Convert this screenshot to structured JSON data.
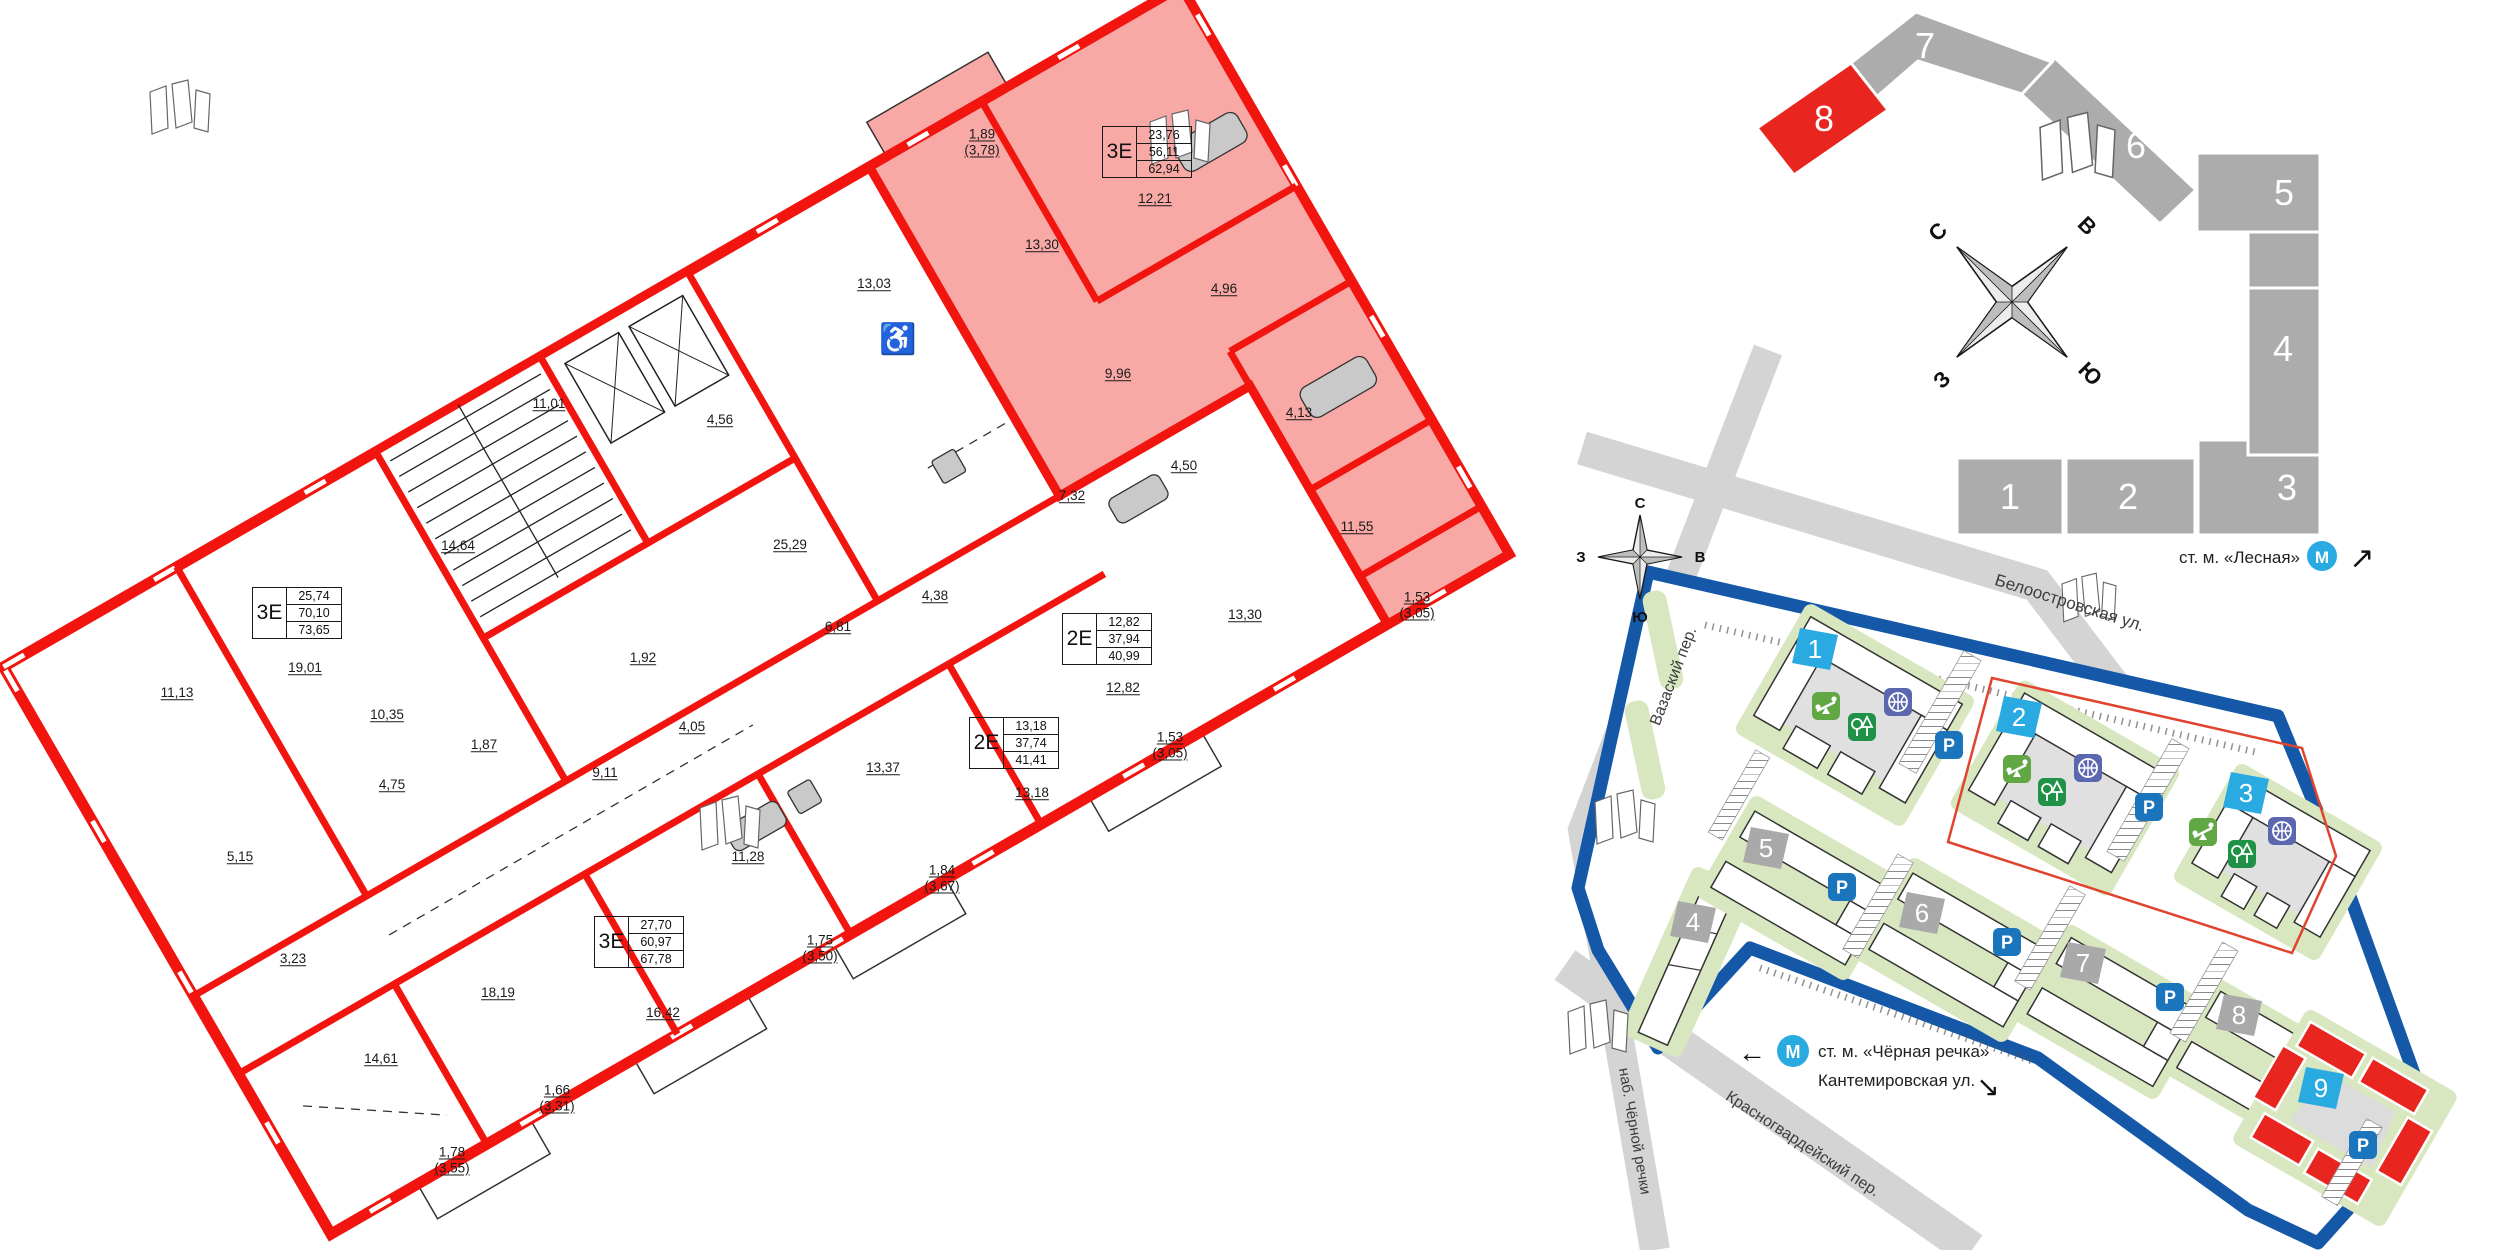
{
  "floor_plan": {
    "wheelchair_icon": "♿",
    "apartment_boxes": [
      {
        "type": "3Е",
        "values": [
          "23,76",
          "56,11",
          "62,94"
        ],
        "highlighted": true
      },
      {
        "type": "2Е",
        "values": [
          "12,82",
          "37,94",
          "40,99"
        ],
        "highlighted": false
      },
      {
        "type": "2Е",
        "values": [
          "13,18",
          "37,74",
          "41,41"
        ],
        "highlighted": false
      },
      {
        "type": "3Е",
        "values": [
          "25,74",
          "70,10",
          "73,65"
        ],
        "highlighted": false
      },
      {
        "type": "3Е",
        "values": [
          "27,70",
          "60,97",
          "67,78"
        ],
        "highlighted": false
      }
    ],
    "room_labels": [
      {
        "area": "1,89",
        "sub": "(3,78)"
      },
      {
        "area": "12,21"
      },
      {
        "area": "13,30"
      },
      {
        "area": "4,96"
      },
      {
        "area": "9,96"
      },
      {
        "area": "4,13"
      },
      {
        "area": "11,55"
      },
      {
        "area": "1,53",
        "sub": "(3,05)"
      },
      {
        "area": "4,50"
      },
      {
        "area": "7,32"
      },
      {
        "area": "13,30"
      },
      {
        "area": "12,82"
      },
      {
        "area": "1,53",
        "sub": "(3,05)"
      },
      {
        "area": "13,18"
      },
      {
        "area": "13,03"
      },
      {
        "area": "4,56"
      },
      {
        "area": "11,01"
      },
      {
        "area": "14,64"
      },
      {
        "area": "25,29"
      },
      {
        "area": "11,13"
      },
      {
        "area": "19,01"
      },
      {
        "area": "10,35"
      },
      {
        "area": "1,87"
      },
      {
        "area": "4,75"
      },
      {
        "area": "5,15"
      },
      {
        "area": "3,23"
      },
      {
        "area": "18,19"
      },
      {
        "area": "14,61"
      },
      {
        "area": "1,78",
        "sub": "(3,55)"
      },
      {
        "area": "1,66",
        "sub": "(3,31)"
      },
      {
        "area": "16,42"
      },
      {
        "area": "11,28"
      },
      {
        "area": "1,75",
        "sub": "(3,50)"
      },
      {
        "area": "1,84",
        "sub": "(3,67)"
      },
      {
        "area": "13,37"
      },
      {
        "area": "6,81"
      },
      {
        "area": "4,38"
      },
      {
        "area": "9,11"
      },
      {
        "area": "4,05"
      },
      {
        "area": "1,92"
      }
    ]
  },
  "building_diagram": {
    "sections": [
      {
        "n": "1",
        "active": false
      },
      {
        "n": "2",
        "active": false
      },
      {
        "n": "3",
        "active": false
      },
      {
        "n": "4",
        "active": false
      },
      {
        "n": "5",
        "active": false
      },
      {
        "n": "6",
        "active": false
      },
      {
        "n": "7",
        "active": false
      },
      {
        "n": "8",
        "active": true
      }
    ],
    "compass": {
      "n": "С",
      "e": "В",
      "s": "Ю",
      "w": "З"
    },
    "metro": {
      "label": "ст. м. «Лесная»",
      "logo": "М",
      "arrow": "↗"
    }
  },
  "site_map": {
    "compass": {
      "n": "С",
      "e": "В",
      "s": "Ю",
      "w": "З"
    },
    "streets": [
      {
        "name": "Белоостровская ул."
      },
      {
        "name": "Вазаский пер."
      },
      {
        "name": "наб. Чёрной речки"
      },
      {
        "name": "Красногвардейский пер."
      }
    ],
    "metro_station": {
      "label": "ст. м. «Чёрная речка»",
      "logo": "М",
      "arrow": "←"
    },
    "kantemirovskaya": {
      "label": "Кантемировская ул.",
      "arrow": "↘"
    },
    "markers": [
      {
        "n": "1",
        "color": "#29ABE2"
      },
      {
        "n": "2",
        "color": "#29ABE2"
      },
      {
        "n": "3",
        "color": "#29ABE2"
      },
      {
        "n": "4",
        "color": "#A9A9A9"
      },
      {
        "n": "5",
        "color": "#A9A9A9"
      },
      {
        "n": "6",
        "color": "#A9A9A9"
      },
      {
        "n": "7",
        "color": "#A9A9A9"
      },
      {
        "n": "8",
        "color": "#A9A9A9"
      },
      {
        "n": "9",
        "color": "#29ABE2"
      }
    ],
    "icons": {
      "parking_label": "Р"
    }
  },
  "colors": {
    "wall_red": "#F2150F",
    "highlight_pink": "#F8A9A6",
    "section_gray": "#ACACAC",
    "section_red": "#E8251F",
    "boundary_blue": "#1558A8",
    "marker_blue": "#29ABE2",
    "parking_blue": "#1B75BC",
    "basketball_indigo": "#5B67AE",
    "playground_green": "#61A744",
    "trees_green": "#1F9247",
    "map_green": "#D9E7C0",
    "street_gray": "#D4D4D4"
  }
}
